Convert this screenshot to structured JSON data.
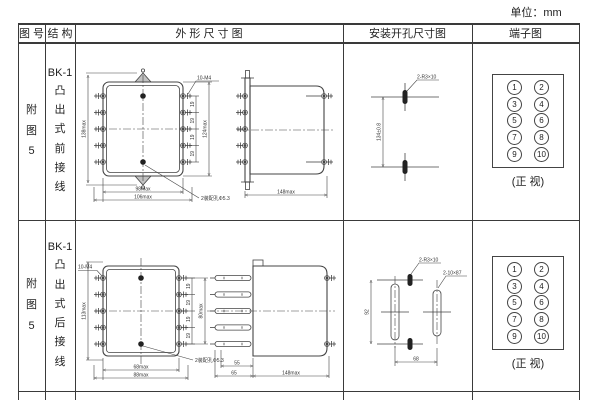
{
  "page": {
    "unit_label": "单位：mm"
  },
  "table_headers": {
    "fig_no": "图 号",
    "structure": "结 构",
    "outline": "外 形 尺 寸 图",
    "mounting": "安装开孔尺寸图",
    "terminal": "端子图"
  },
  "rows": [
    {
      "fig_no": "附图5",
      "model": "BK-1",
      "wiring": "凸出式前接线",
      "outline_front": {
        "screws": "10-M4",
        "height_overall": "138max",
        "height_terminals": "124max",
        "pitch": "19",
        "width_body": "98max",
        "width_overall": "106max",
        "holes": "2装配孔Φ5.3"
      },
      "outline_side": {
        "depth": "148max"
      },
      "mounting": {
        "slots": "2-R3×10",
        "vertical_spacing": "134±0.8"
      },
      "terminal_caption": "(正 视)"
    },
    {
      "fig_no": "附图5",
      "model": "BK-1",
      "wiring": "凸出式后接线",
      "outline_front": {
        "screws": "10-M4",
        "height_overall": "113max",
        "height_terminals": "80max",
        "pitch": "19",
        "width_body": "68max",
        "width_overall": "88max",
        "holes": "2装配孔Φ5.3"
      },
      "outline_side": {
        "pin_length": "55",
        "pin_overall": "65",
        "depth": "148max"
      },
      "mounting": {
        "slots": "2-R3×10",
        "slots2": "2-10×87",
        "vertical_spacing": "92",
        "horizontal_spacing": "68"
      },
      "terminal_caption": "(正 视)"
    }
  ],
  "terminals": [
    "1",
    "2",
    "3",
    "4",
    "5",
    "6",
    "7",
    "8",
    "9",
    "10"
  ]
}
